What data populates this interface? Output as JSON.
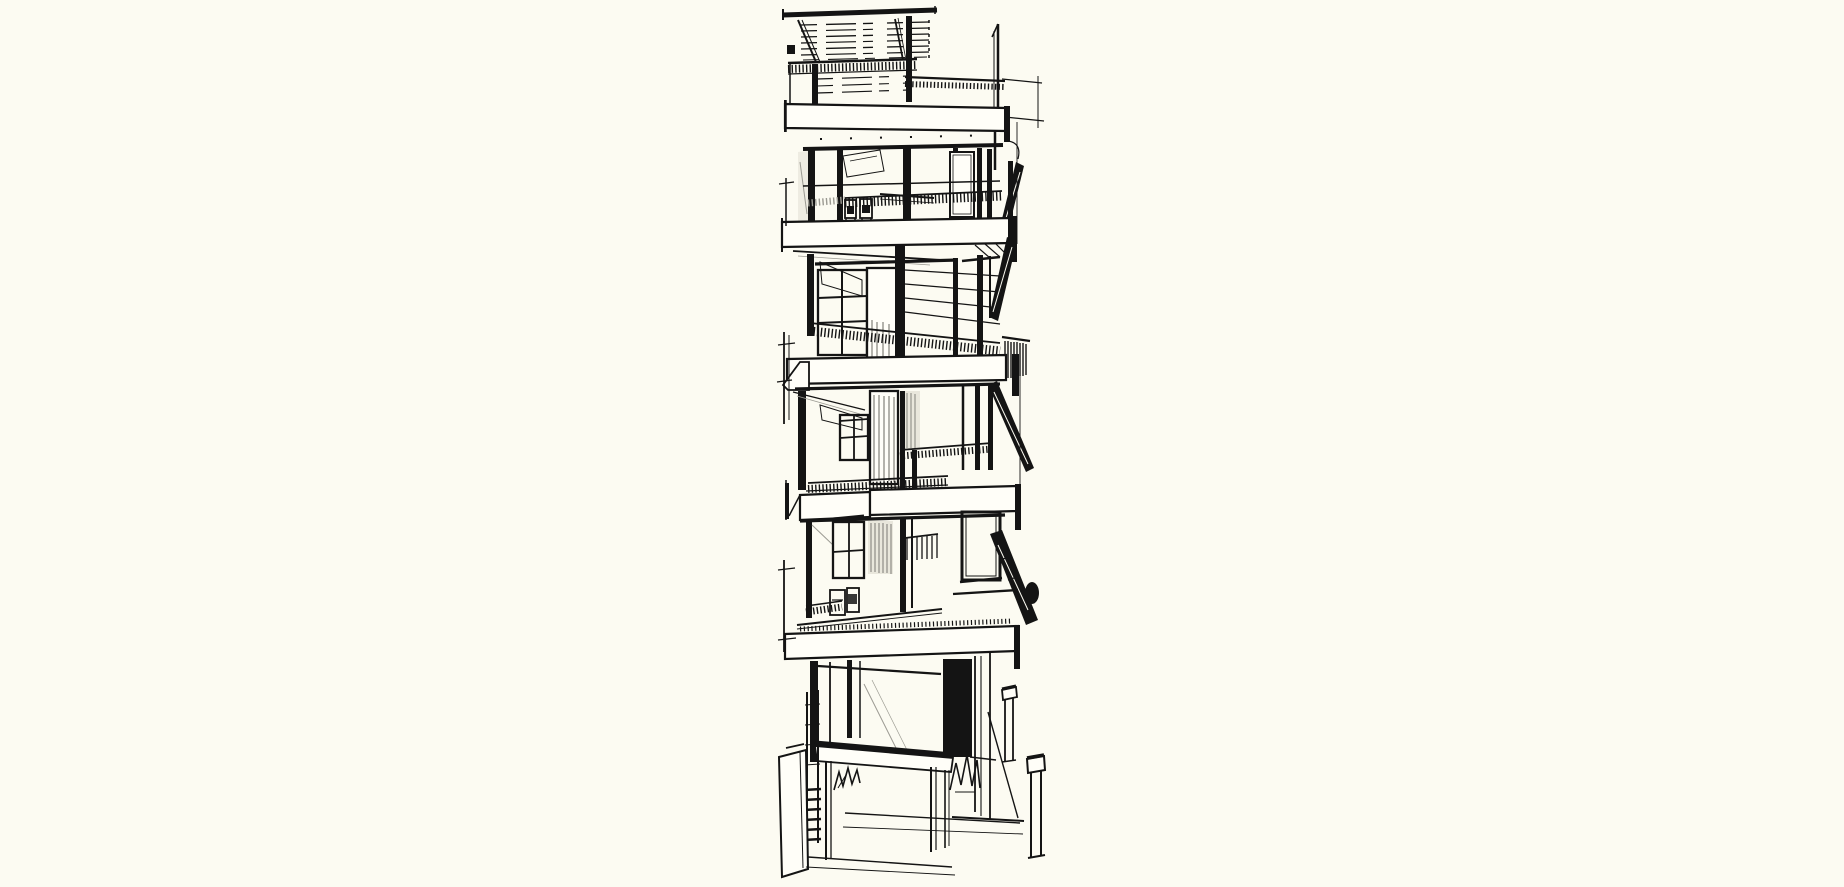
{
  "image": {
    "title": "Pen-and-ink architectural sketch of a narrow five-storey building with stacked balconies, glazed facades, a side switchback stair, a roof pergola terrace and a ground-floor entrance canopy",
    "medium": "black ink line drawing on cream paper"
  },
  "palette": {
    "background": "#fcfbf2",
    "paper_highlight": "#fffef8",
    "ink": "#141414",
    "gray": "#9b9a92",
    "pale_glass": "#e9e7dc"
  },
  "scene": {
    "parts": [
      "roof pergola with slanted struts",
      "roof terrace railing with wire mesh",
      "five white balcony slab bands",
      "glazed floors with dark mullions",
      "balcony mesh guardrails",
      "terrace chairs and table",
      "side switchback stair flights",
      "curtained door panels",
      "ground-floor storefront",
      "dark entry doorway",
      "entrance canopy on posts",
      "planting scribbles",
      "leaning site panel and ladder",
      "two street bollards",
      "left scaffold poles"
    ]
  }
}
